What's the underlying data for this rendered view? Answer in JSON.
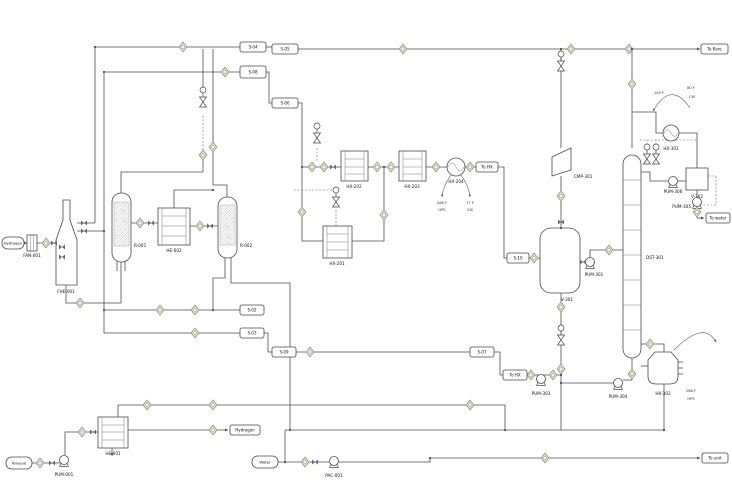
{
  "diagram": {
    "feeds": {
      "hydrogen": "Hydrogen",
      "toluene": "Toluene",
      "water": "Water"
    },
    "products": {
      "to_flare": "To flare",
      "to_water": "To water",
      "to_unit": "To unit",
      "hydrogen_out": "Hydrogen"
    },
    "equipment": {
      "fan001": "FAN-001",
      "fhe001": "FHE-001",
      "r001": "R-001",
      "he002": "HE-002",
      "r002": "R-002",
      "hx201": "HX-201",
      "hx202": "HX-202",
      "hx203": "HX-203",
      "hx204": "HX-204",
      "cmp301": "CMP-301",
      "v301": "V-301",
      "pum301": "PUM-301",
      "dst301": "DST-301",
      "hx301": "HX-301",
      "pum306": "PUM-306",
      "v302": "V-302",
      "pum305": "PUM-305",
      "pum304": "PUM-304",
      "hx302": "HX-302",
      "pum303": "PUM-303",
      "he001": "HE-001",
      "pum001": "PUM-001",
      "pac001": "PAC-001"
    },
    "annotations": {
      "hx204_temp_left": "268 F",
      "hx204_util_left": "HPS",
      "hx204_temp_right": "77 F",
      "hx204_util_right": "CW",
      "hx301_temp_left": "100 F",
      "hx301_temp_right": "80 F",
      "hx301_util_right": "CW",
      "hx302_temp": "268 F",
      "hx302_util": "HPS"
    },
    "stream_tags": {
      "s02": "S-02",
      "s03": "S-03",
      "s04": "S-04",
      "s05": "S-05",
      "s06": "S-06",
      "s07": "S-07",
      "s08": "S-08",
      "s09": "S-09",
      "s10": "S-10",
      "to_hx_1": "To HX",
      "to_hx_2": "To HX"
    },
    "colors": {
      "line": "#4d4d4d",
      "indicator_fill": "#deddc8",
      "indicator_stroke": "#8f8f75"
    }
  }
}
